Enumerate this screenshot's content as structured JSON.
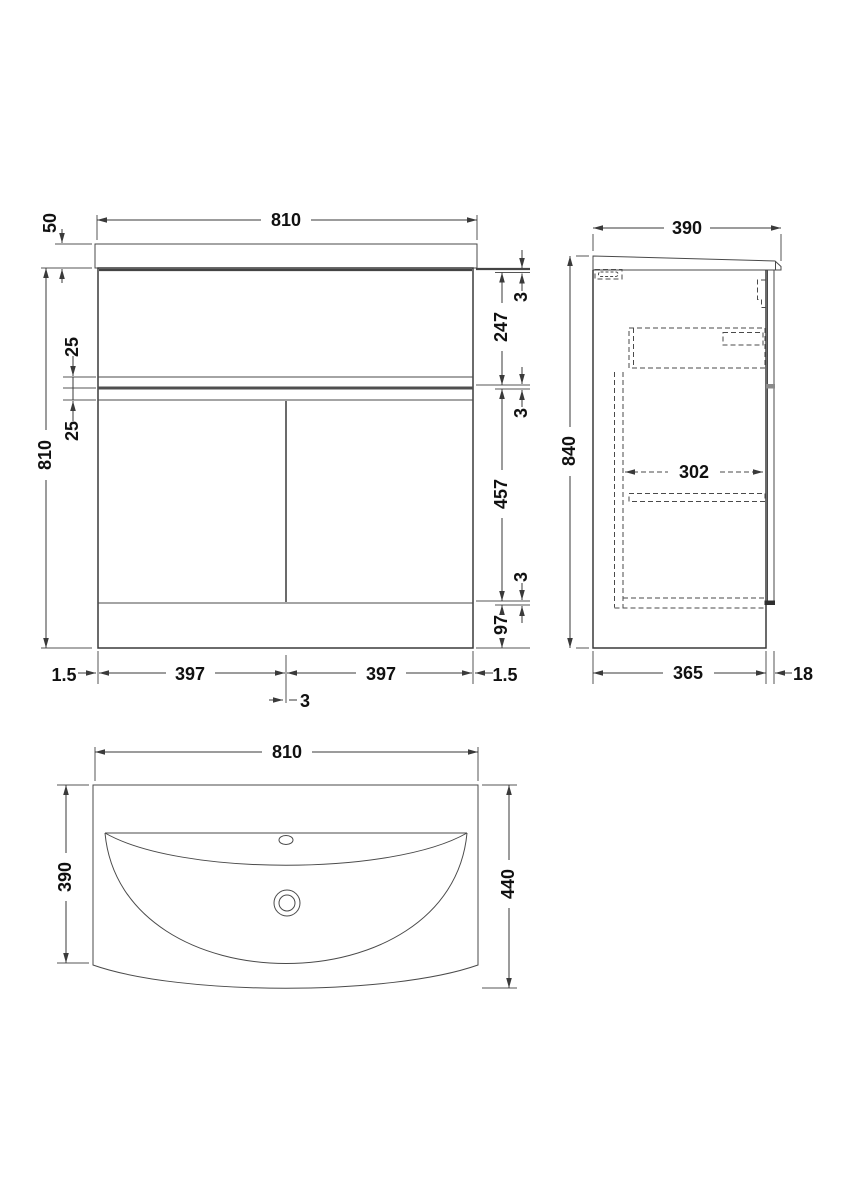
{
  "drawing": {
    "palette": {
      "background": "#ffffff",
      "line": "#3a3a3a",
      "hidden_line": "#4a4a4a",
      "text": "#111111"
    },
    "views": {
      "front": {
        "top_width": "810",
        "worktop_height": "50",
        "left_height": "810",
        "rail_upper": "25",
        "rail_lower": "25",
        "gap_top": "3",
        "drawer_front_height": "247",
        "gap_mid": "3",
        "door_height": "457",
        "gap_low": "3",
        "plinth_height": "97",
        "edge_gap_left": "1.5",
        "door_width_left": "397",
        "door_gap": "3",
        "door_width_right": "397",
        "edge_gap_right": "1.5"
      },
      "side": {
        "depth": "390",
        "height": "840",
        "drawer_internal_depth": "302",
        "carcass_depth": "365",
        "door_thickness": "18"
      },
      "plan": {
        "width": "810",
        "basin_depth": "390",
        "overall_depth": "440"
      }
    }
  }
}
